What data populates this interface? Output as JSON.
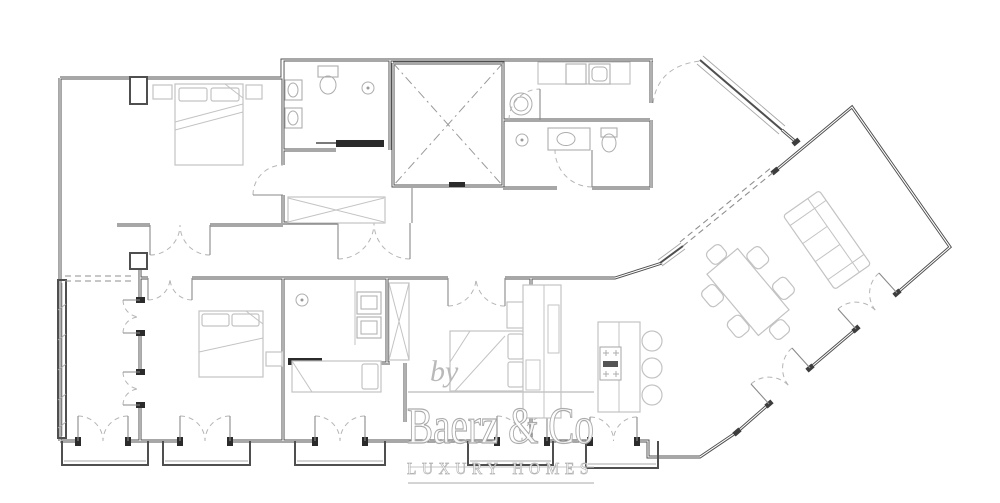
{
  "watermark": {
    "prefix": "by",
    "brand": "Baerz & Co",
    "tagline": "LUXURY HOMES"
  },
  "colors": {
    "background": "#ffffff",
    "wall": "#4f4f4f",
    "wall_core": "#ffffff",
    "furniture": "#c3c3c3",
    "fixture": "#adadad",
    "door_arc": "#b5b5b5",
    "dash_line": "#8f8f8f",
    "dark_door_slab": "#2b2b2b",
    "watermark_stroke": "#ababab",
    "watermark_fill": "#ffffff",
    "watermark_rule": "#c6c6c6"
  }
}
